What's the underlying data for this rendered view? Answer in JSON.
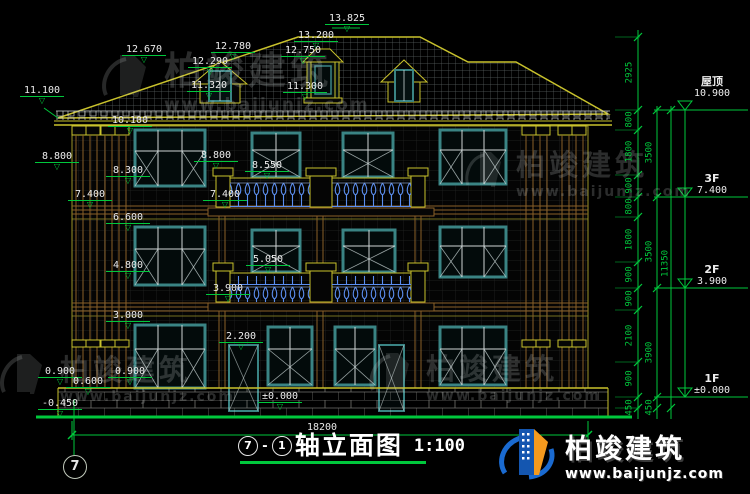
{
  "drawing": {
    "title": {
      "bubble_left": "7",
      "dash": "-",
      "bubble_right": "1",
      "text": "轴立面图",
      "scale": "1:100"
    },
    "axis_bubble": "7",
    "total_width": "18200"
  },
  "markers": [
    "13.825",
    "13.200",
    "12.780",
    "12.750",
    "12.670",
    "12.290",
    "11.320",
    "11.300",
    "11.100",
    "10.100",
    "8.800",
    "8.300",
    "7.400",
    "6.600",
    "4.800",
    "3.000",
    "0.900",
    "0.600",
    "0.900",
    "-0.450",
    "8.800",
    "8.550",
    "7.400",
    "5.050",
    "3.900",
    "2.200",
    "±0.000"
  ],
  "dims": {
    "inner": [
      "2925",
      "800",
      "1800",
      "900",
      "800",
      "1800",
      "900",
      "900",
      "2100",
      "900",
      "450"
    ],
    "mid": [
      "3500",
      "3500",
      "3900",
      "450"
    ],
    "outer": [
      "11350"
    ]
  },
  "levels": [
    {
      "label": "屋顶",
      "value": "10.900"
    },
    {
      "label": "3F",
      "value": "7.400"
    },
    {
      "label": "2F",
      "value": "3.900"
    },
    {
      "label": "1F",
      "value": "±0.000"
    }
  ],
  "brand": {
    "name": "柏竣建筑",
    "url": "www.baijunjz.com"
  },
  "icons": {
    "elevation_marker": "▽"
  },
  "colors": {
    "line_yellow": "#c9c22c",
    "line_green": "#00c83c",
    "window_teal": "#3a8484",
    "baluster_blue": "#5b8ef0",
    "logo_blue": "#1a6ad0",
    "logo_orange": "#f59a1e"
  }
}
